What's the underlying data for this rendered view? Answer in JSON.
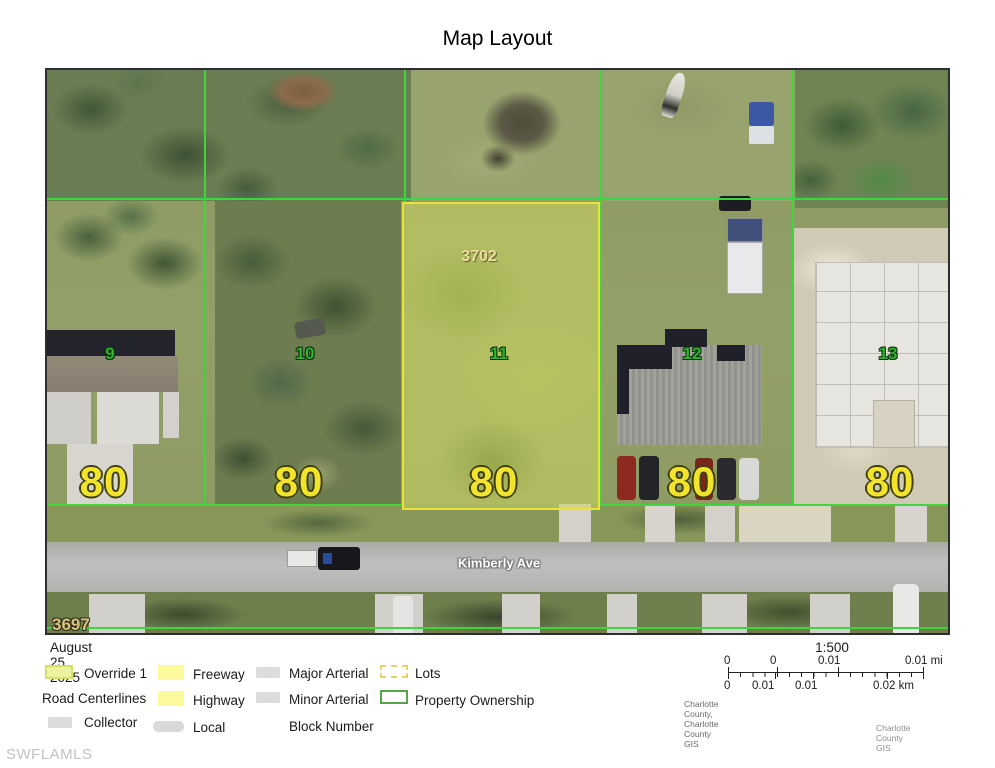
{
  "title": "Map Layout",
  "map": {
    "street": "Kimberly Ave",
    "parcel_id": "3702",
    "block_number": "3697",
    "lots": [
      {
        "number": "9",
        "width": "80"
      },
      {
        "number": "10",
        "width": "80"
      },
      {
        "number": "11",
        "width": "80"
      },
      {
        "number": "12",
        "width": "80"
      },
      {
        "number": "13",
        "width": "80"
      }
    ],
    "colors": {
      "parcel_line": "#3fd53f",
      "highlight_lot_border": "#e8e336",
      "lot_number_text": "#2db32d",
      "dimension_text": "#f2e32b"
    }
  },
  "legend": {
    "date": "August 25, 2025",
    "items": {
      "override": "Override 1",
      "road_centerlines": "Road Centerlines",
      "collector": "Collector",
      "freeway": "Freeway",
      "highway": "Highway",
      "local": "Local",
      "major_arterial": "Major Arterial",
      "minor_arterial": "Minor Arterial",
      "block_number": "Block Number",
      "lots": "Lots",
      "property_ownership": "Property Ownership"
    }
  },
  "scalebar": {
    "ratio": "1:500",
    "mi": [
      "0",
      "0",
      "0.01",
      "0.01 mi"
    ],
    "km": [
      "0",
      "0.01",
      "0.01",
      "0.02 km"
    ],
    "attribution": "Charlotte County, Charlotte County GIS",
    "credit": "Charlotte County GIS"
  },
  "watermark": "SWFLAMLS"
}
